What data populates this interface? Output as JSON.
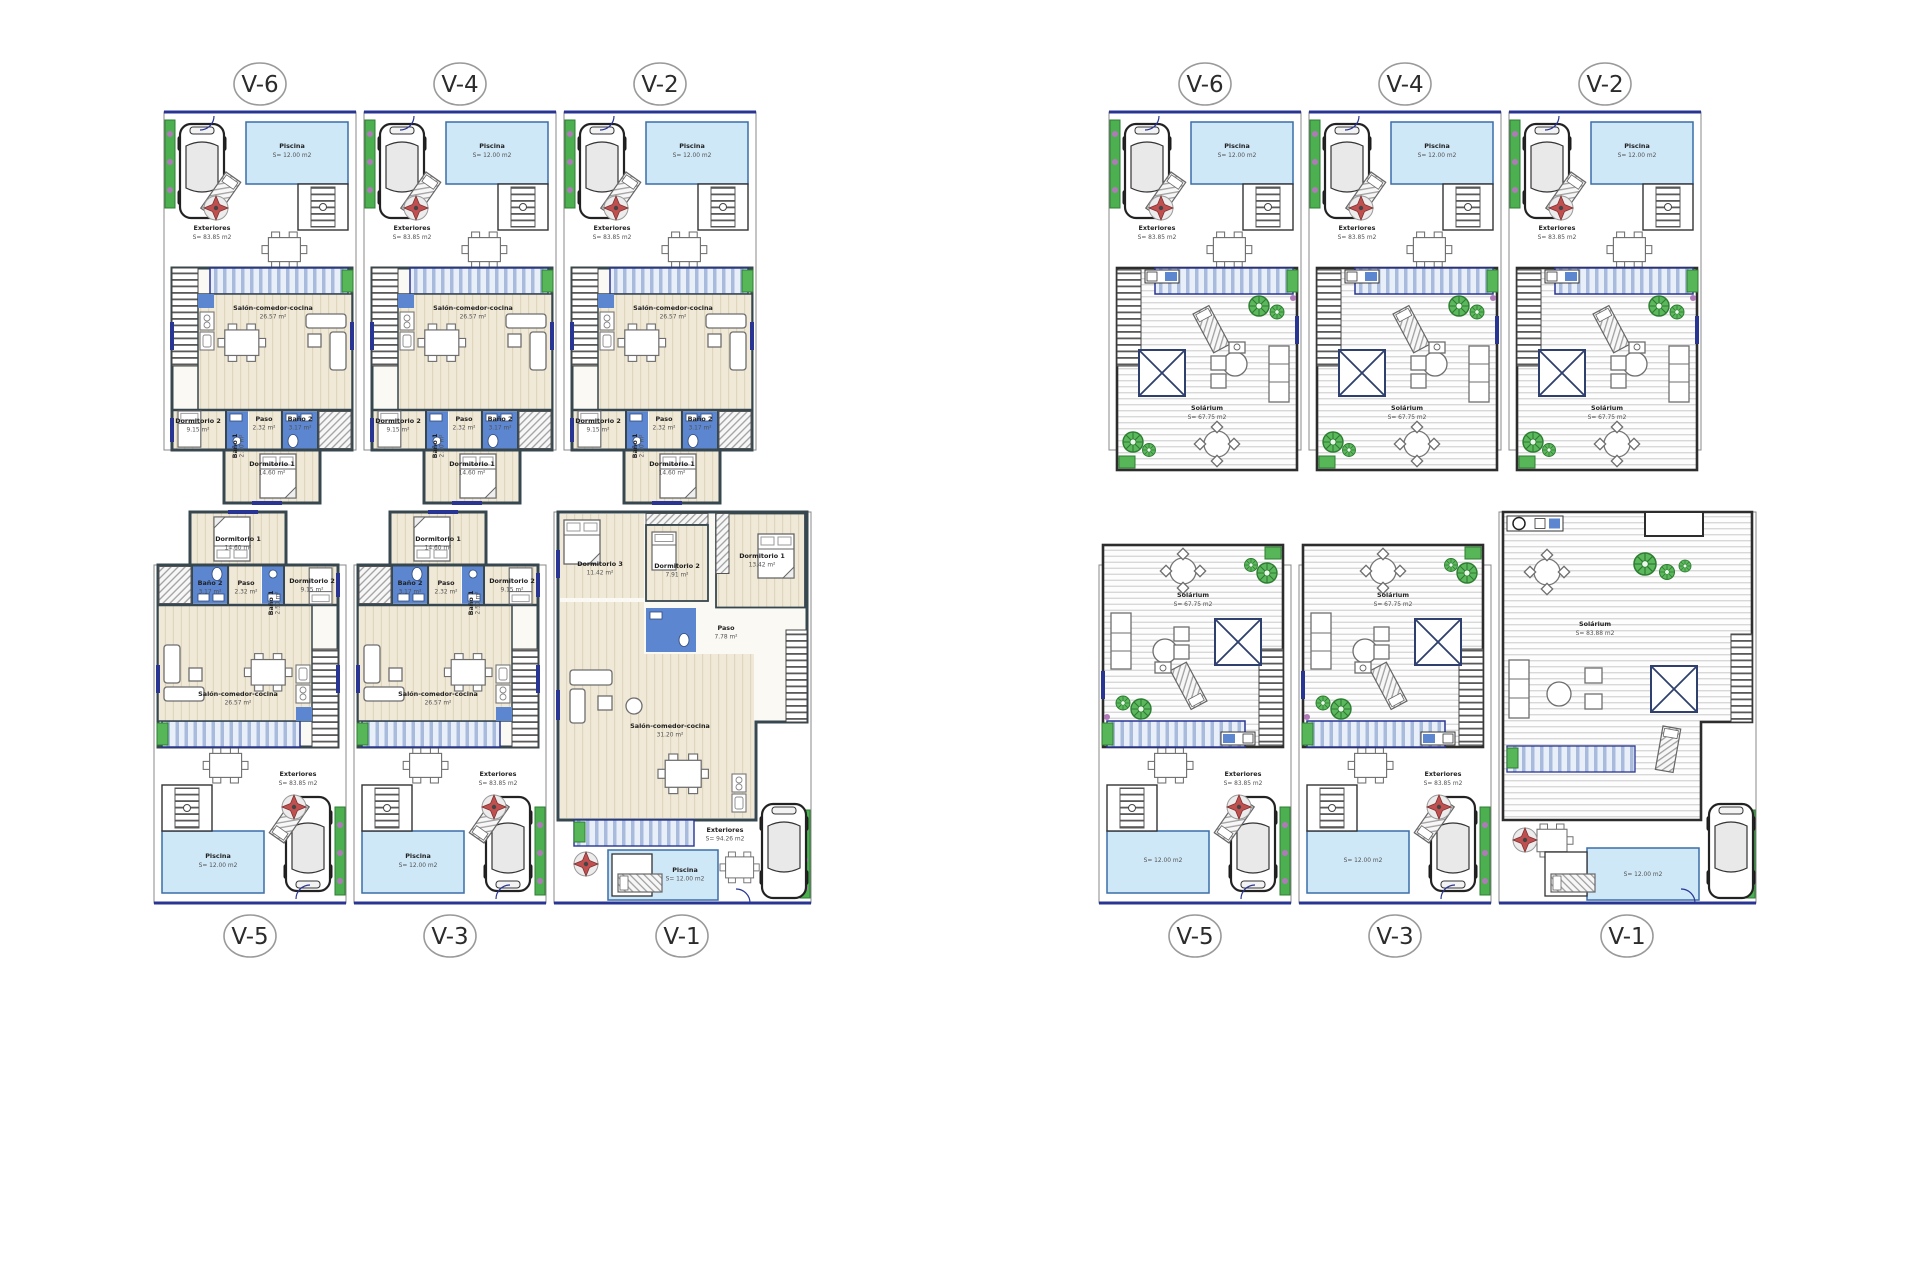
{
  "colors": {
    "street_line": "#283593",
    "ground_wall": "#37474f",
    "solarium_wall": "#2d2d2d",
    "pool_fill": "#cfe8f7",
    "pool_stroke": "#3a6ea8",
    "bath_fill": "#5c86cf",
    "terrace_stripe": "#a8bbdc",
    "hedge_green": "#4caf50",
    "flower_purple": "#b07ab8",
    "wood_floor": "#f0e9d8"
  },
  "units": {
    "g6": {
      "code": "V-6",
      "piscina": "Piscina",
      "piscina_area": "S= 12.00 m2",
      "exteriores": "Exteriores",
      "exteriores_area": "S= 83.85 m2",
      "salon": "Salón-comedor-cocina",
      "salon_area": "26.57 m²",
      "paso": "Paso",
      "paso_area": "2.32 m²",
      "bano2": "Baño 2",
      "bano2_area": "3.17 m²",
      "dormitorio2": "Dormitorio 2",
      "dormitorio2_area": "9.15 m²",
      "bano1": "Baño 1",
      "bano1_area": "2.50 m²",
      "dormitorio1": "Dormitorio 1",
      "dormitorio1_area": "14.60 m²"
    },
    "g4": {
      "code": "V-4",
      "piscina": "Piscina",
      "piscina_area": "S= 12.00 m2",
      "exteriores": "Exteriores",
      "exteriores_area": "S= 83.85 m2",
      "salon": "Salón-comedor-cocina",
      "salon_area": "26.57 m²",
      "paso": "Paso",
      "paso_area": "2.32 m²",
      "bano2": "Baño 2",
      "bano2_area": "3.17 m²",
      "dormitorio2": "Dormitorio 2",
      "dormitorio2_area": "9.15 m²",
      "bano1": "Baño 1",
      "bano1_area": "2.50 m²",
      "dormitorio1": "Dormitorio 1",
      "dormitorio1_area": "14.60 m²"
    },
    "g2": {
      "code": "V-2",
      "piscina": "Piscina",
      "piscina_area": "S= 12.00 m2",
      "exteriores": "Exteriores",
      "exteriores_area": "S= 83.85 m2",
      "salon": "Salón-comedor-cocina",
      "salon_area": "26.57 m²",
      "paso": "Paso",
      "paso_area": "2.32 m²",
      "bano2": "Baño 2",
      "bano2_area": "3.17 m²",
      "dormitorio2": "Dormitorio 2",
      "dormitorio2_area": "9.15 m²",
      "bano1": "Baño 1",
      "bano1_area": "2.50 m²",
      "dormitorio1": "Dormitorio 1",
      "dormitorio1_area": "14.60 m²"
    },
    "g5": {
      "code": "V-5",
      "piscina": "Piscina",
      "piscina_area": "S= 12.00 m2",
      "exteriores": "Exteriores",
      "exteriores_area": "S= 83.85 m2",
      "salon": "Salón-comedor-cocina",
      "salon_area": "26.57 m²",
      "paso": "Paso",
      "paso_area": "2.32 m²",
      "bano2": "Baño 2",
      "bano2_area": "3.17 m²",
      "dormitorio2": "Dormitorio 2",
      "dormitorio2_area": "9.15 m²",
      "bano1": "Baño 1",
      "bano1_area": "2.50 m²",
      "dormitorio1": "Dormitorio 1",
      "dormitorio1_area": "14.60 m²"
    },
    "g3": {
      "code": "V-3",
      "piscina": "Piscina",
      "piscina_area": "S= 12.00 m2",
      "exteriores": "Exteriores",
      "exteriores_area": "S= 83.85 m2",
      "salon": "Salón-comedor-cocina",
      "salon_area": "26.57 m²",
      "paso": "Paso",
      "paso_area": "2.32 m²",
      "bano2": "Baño 2",
      "bano2_area": "3.17 m²",
      "dormitorio2": "Dormitorio 2",
      "dormitorio2_area": "9.15 m²",
      "bano1": "Baño 1",
      "bano1_area": "2.50 m²",
      "dormitorio1": "Dormitorio 1",
      "dormitorio1_area": "14.60 m²"
    },
    "g1": {
      "code": "V-1",
      "piscina": "Piscina",
      "piscina_area": "S= 12.00 m2",
      "exteriores": "Exteriores",
      "exteriores_area": "S= 94.26 m2",
      "salon": "Salón-comedor-cocina",
      "salon_area": "31.20 m²",
      "paso": "Paso",
      "paso_area": "7.78 m²",
      "dormitorio1": "Dormitorio 1",
      "dormitorio1_area": "13.42 m²",
      "dormitorio2": "Dormitorio 2",
      "dormitorio2_area": "7.91 m²",
      "dormitorio3": "Dormitorio 3",
      "dormitorio3_area": "11.42 m²"
    },
    "s6": {
      "code": "V-6",
      "piscina": "Piscina",
      "piscina_area": "S= 12.00 m2",
      "exteriores": "Exteriores",
      "exteriores_area": "S= 83.85 m2",
      "solarium": "Solárium",
      "solarium_area": "S= 67.75 m2"
    },
    "s4": {
      "code": "V-4",
      "piscina": "Piscina",
      "piscina_area": "S= 12.00 m2",
      "exteriores": "Exteriores",
      "exteriores_area": "S= 83.85 m2",
      "solarium": "Solárium",
      "solarium_area": "S= 67.75 m2"
    },
    "s2": {
      "code": "V-2",
      "piscina": "Piscina",
      "piscina_area": "S= 12.00 m2",
      "exteriores": "Exteriores",
      "exteriores_area": "S= 83.85 m2",
      "solarium": "Solárium",
      "solarium_area": "S= 67.75 m2"
    },
    "s5": {
      "code": "V-5",
      "piscina_area": "S= 12.00 m2",
      "exteriores": "Exteriores",
      "exteriores_area": "S= 83.85 m2",
      "solarium": "Solárium",
      "solarium_area": "S= 67.75 m2"
    },
    "s3": {
      "code": "V-3",
      "piscina_area": "S= 12.00 m2",
      "exteriores": "Exteriores",
      "exteriores_area": "S= 83.85 m2",
      "solarium": "Solárium",
      "solarium_area": "S= 67.75 m2"
    },
    "s1": {
      "code": "V-1",
      "piscina_area": "S= 12.00 m2",
      "solarium": "Solárium",
      "solarium_area": "S= 83.88 m2"
    }
  }
}
